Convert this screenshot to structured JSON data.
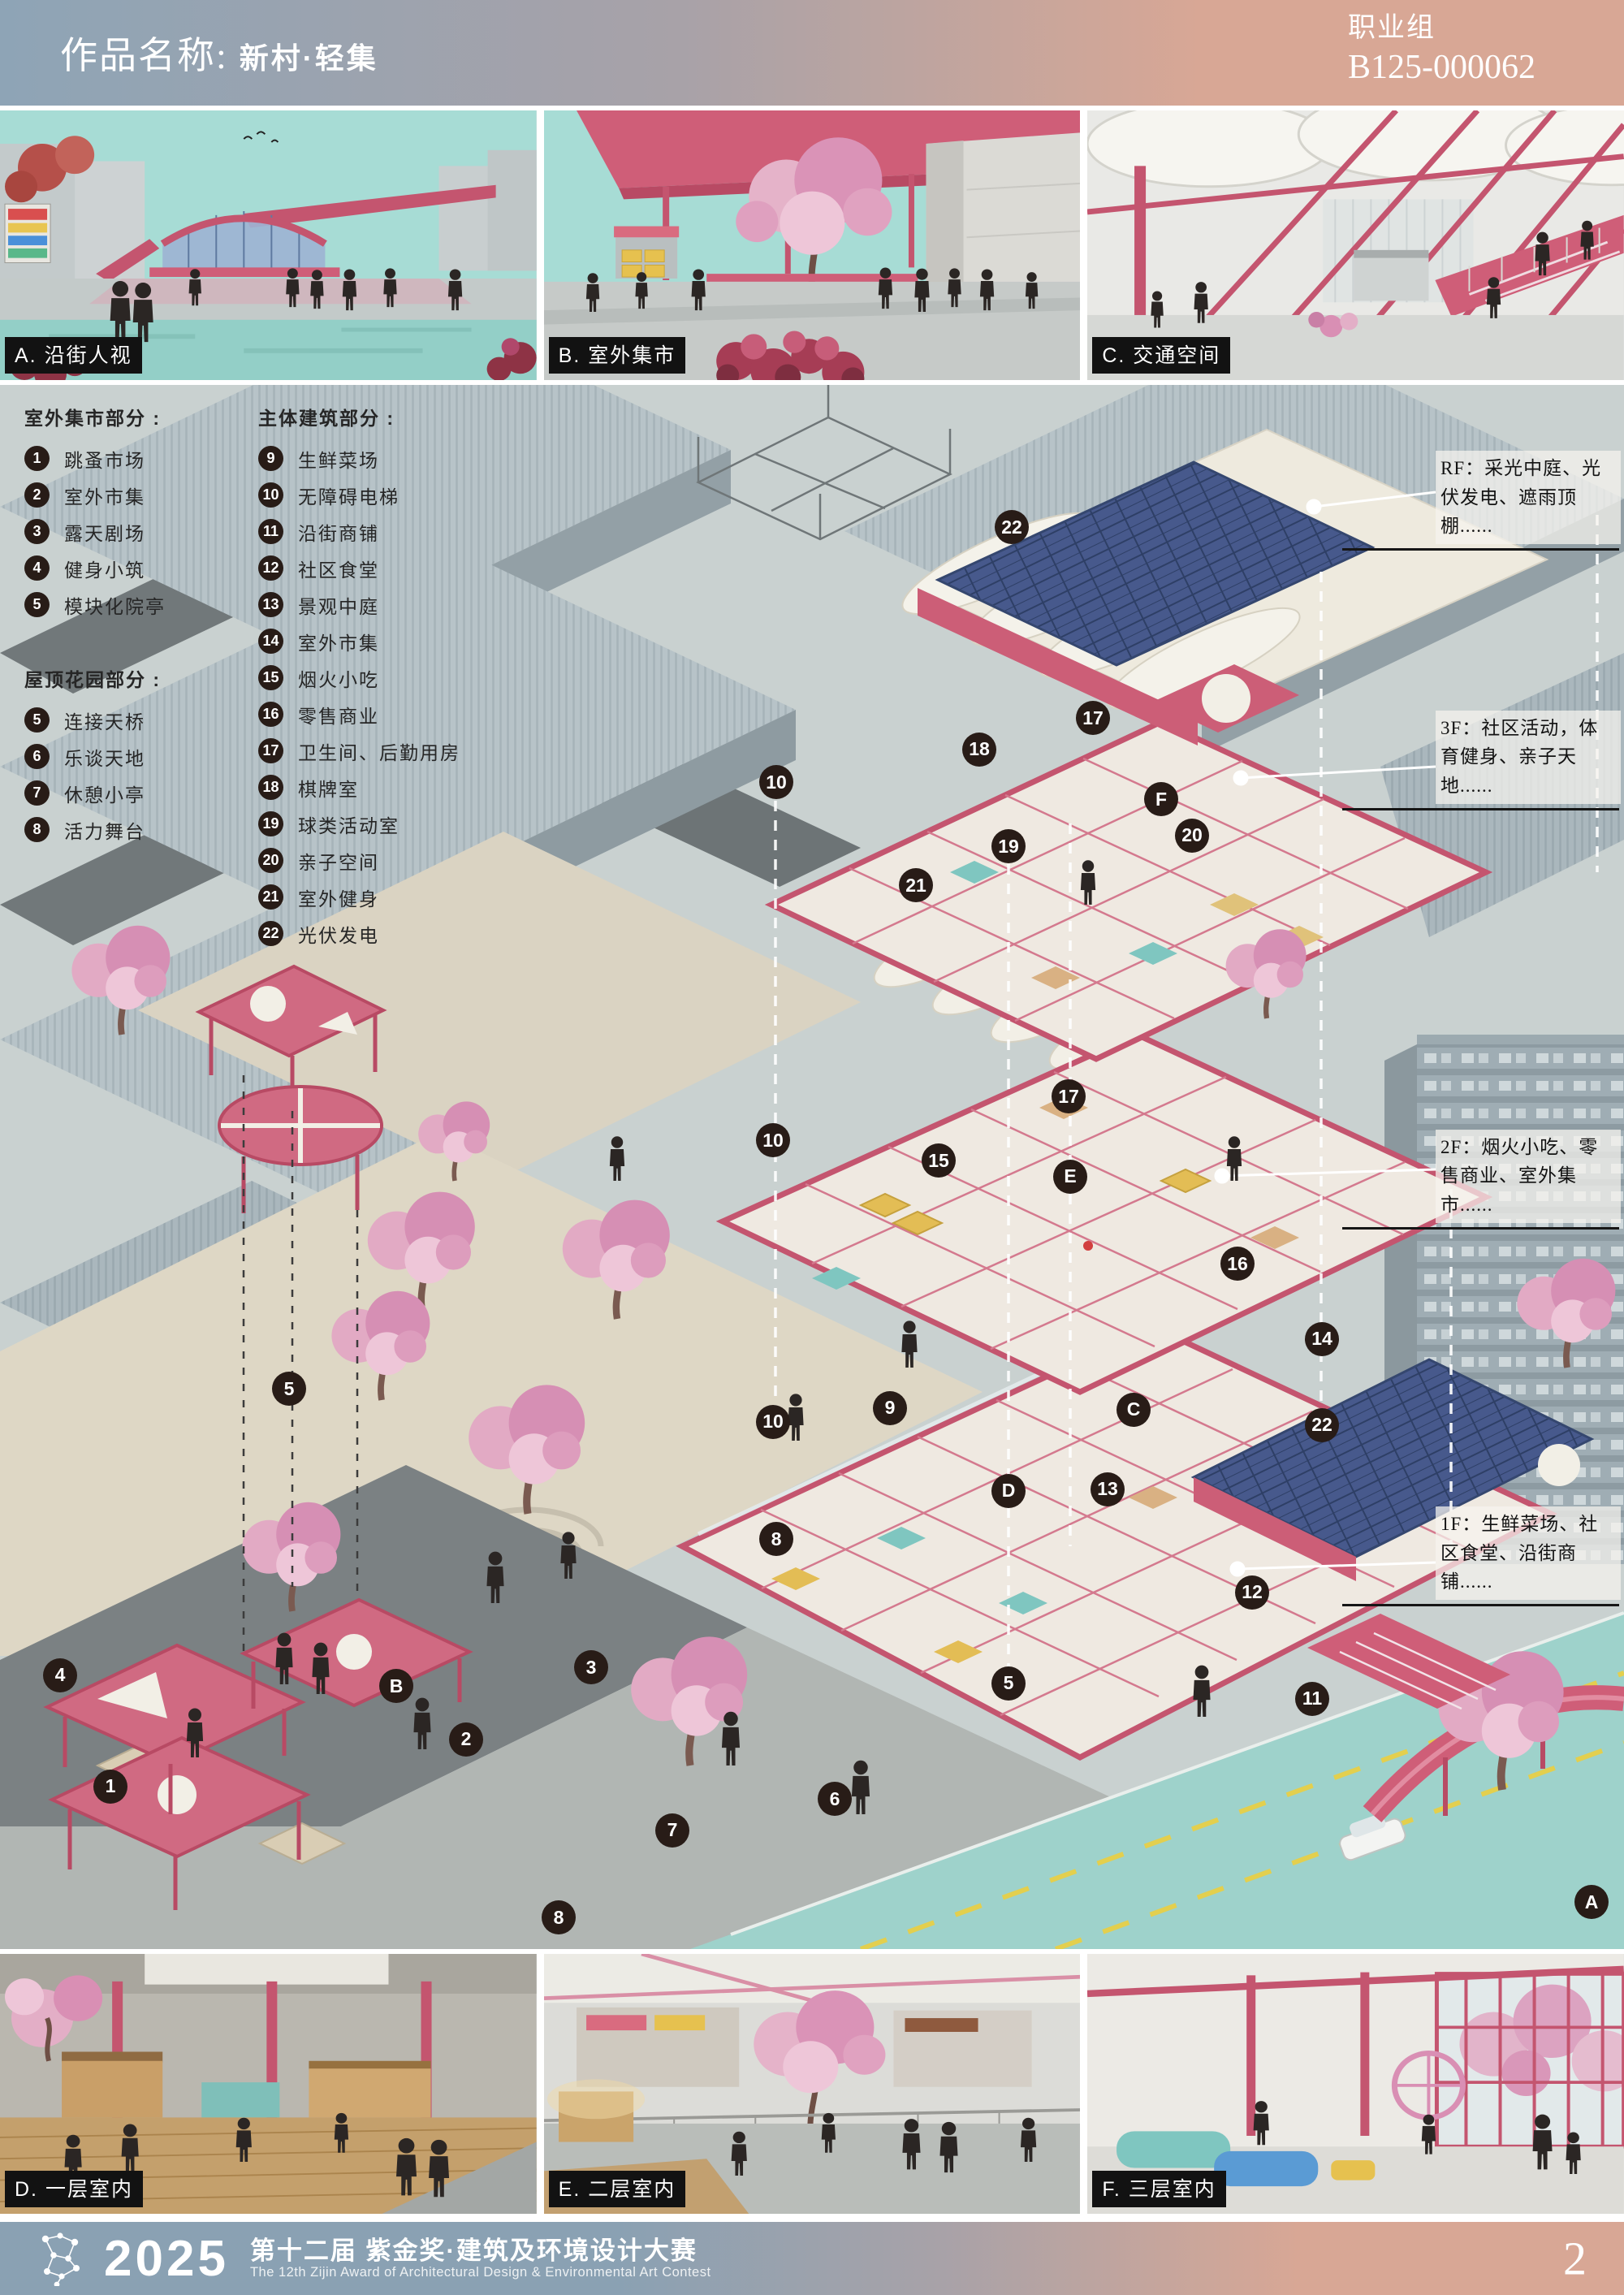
{
  "header": {
    "title_label": "作品名称:",
    "title": "新村·轻集",
    "group": "职业组",
    "entry_id": "B125-000062"
  },
  "top_photos": [
    {
      "id": "A",
      "label": "A. 沿街人视"
    },
    {
      "id": "B",
      "label": "B. 室外集市"
    },
    {
      "id": "C",
      "label": "C. 交通空间"
    }
  ],
  "bottom_photos": [
    {
      "id": "D",
      "label": "D. 一层室内"
    },
    {
      "id": "E",
      "label": "E. 二层室内"
    },
    {
      "id": "F",
      "label": "F. 三层室内"
    }
  ],
  "legend": {
    "groups": [
      {
        "title": "室外集市部分 :",
        "items": [
          {
            "num": "1",
            "label": "跳蚤市场"
          },
          {
            "num": "2",
            "label": "室外市集"
          },
          {
            "num": "3",
            "label": "露天剧场"
          },
          {
            "num": "4",
            "label": "健身小筑"
          },
          {
            "num": "5",
            "label": "模块化院亭"
          }
        ]
      },
      {
        "title": "屋顶花园部分 :",
        "items": [
          {
            "num": "5",
            "label": "连接天桥"
          },
          {
            "num": "6",
            "label": "乐谈天地"
          },
          {
            "num": "7",
            "label": "休憩小亭"
          },
          {
            "num": "8",
            "label": "活力舞台"
          }
        ]
      },
      {
        "title": "主体建筑部分 :",
        "items": [
          {
            "num": "9",
            "label": "生鲜菜场"
          },
          {
            "num": "10",
            "label": "无障碍电梯"
          },
          {
            "num": "11",
            "label": "沿街商铺"
          },
          {
            "num": "12",
            "label": "社区食堂"
          },
          {
            "num": "13",
            "label": "景观中庭"
          },
          {
            "num": "14",
            "label": "室外市集"
          },
          {
            "num": "15",
            "label": "烟火小吃"
          },
          {
            "num": "16",
            "label": "零售商业"
          },
          {
            "num": "17",
            "label": "卫生间、后勤用房"
          },
          {
            "num": "18",
            "label": "棋牌室"
          },
          {
            "num": "19",
            "label": "球类活动室"
          },
          {
            "num": "20",
            "label": "亲子空间"
          },
          {
            "num": "21",
            "label": "室外健身"
          },
          {
            "num": "22",
            "label": "光伏发电"
          }
        ]
      }
    ]
  },
  "annotations": [
    {
      "id": "RF",
      "text": "RF：采光中庭、光伏发电、遮雨顶棚......",
      "x": 88.4,
      "y": 4.2
    },
    {
      "id": "3F",
      "text": "3F：社区活动，体育健身、亲子天地......",
      "x": 88.4,
      "y": 20.8
    },
    {
      "id": "2F",
      "text": "2F：烟火小吃、零售商业、室外集市......",
      "x": 88.4,
      "y": 47.6
    },
    {
      "id": "1F",
      "text": "1F：生鲜菜场、社区食堂、沿街商铺......",
      "x": 88.4,
      "y": 71.7
    }
  ],
  "markers": [
    {
      "label": "22",
      "x": 62.3,
      "y": 9.1
    },
    {
      "label": "17",
      "x": 67.3,
      "y": 21.3
    },
    {
      "label": "18",
      "x": 60.3,
      "y": 23.3
    },
    {
      "label": "10",
      "x": 47.8,
      "y": 25.4
    },
    {
      "label": "F",
      "x": 71.5,
      "y": 26.5
    },
    {
      "label": "19",
      "x": 62.1,
      "y": 29.5
    },
    {
      "label": "20",
      "x": 73.4,
      "y": 28.8
    },
    {
      "label": "21",
      "x": 56.4,
      "y": 32.0
    },
    {
      "label": "17",
      "x": 65.8,
      "y": 45.5
    },
    {
      "label": "10",
      "x": 47.6,
      "y": 48.3
    },
    {
      "label": "15",
      "x": 57.8,
      "y": 49.6
    },
    {
      "label": "E",
      "x": 65.9,
      "y": 50.6
    },
    {
      "label": "16",
      "x": 76.2,
      "y": 56.2
    },
    {
      "label": "14",
      "x": 81.4,
      "y": 61.0
    },
    {
      "label": "5",
      "x": 17.8,
      "y": 64.2
    },
    {
      "label": "9",
      "x": 54.8,
      "y": 65.4
    },
    {
      "label": "10",
      "x": 47.6,
      "y": 66.3
    },
    {
      "label": "C",
      "x": 69.8,
      "y": 65.5
    },
    {
      "label": "22",
      "x": 81.4,
      "y": 66.5
    },
    {
      "label": "13",
      "x": 68.2,
      "y": 70.6
    },
    {
      "label": "D",
      "x": 62.1,
      "y": 70.7
    },
    {
      "label": "8",
      "x": 47.8,
      "y": 73.8
    },
    {
      "label": "12",
      "x": 77.1,
      "y": 77.2
    },
    {
      "label": "4",
      "x": 3.7,
      "y": 82.5
    },
    {
      "label": "3",
      "x": 36.4,
      "y": 82.0
    },
    {
      "label": "B",
      "x": 24.4,
      "y": 83.2
    },
    {
      "label": "5",
      "x": 62.1,
      "y": 83.0
    },
    {
      "label": "11",
      "x": 80.8,
      "y": 84.0
    },
    {
      "label": "2",
      "x": 28.7,
      "y": 86.6
    },
    {
      "label": "1",
      "x": 6.8,
      "y": 89.6
    },
    {
      "label": "6",
      "x": 51.4,
      "y": 90.4
    },
    {
      "label": "7",
      "x": 41.4,
      "y": 92.4
    },
    {
      "label": "8",
      "x": 34.4,
      "y": 98.0
    },
    {
      "label": "A",
      "x": 98.0,
      "y": 97.0
    }
  ],
  "footer": {
    "year": "2025",
    "title_cn": "第十二届 紫金奖·建筑及环境设计大赛",
    "title_en": "The 12th Zijin Award of Architectural Design & Environmental Art Contest",
    "page": "2"
  },
  "colors": {
    "grad_left": "#8ea4b6",
    "grad_right": "#d8a795",
    "marker": "#281c17",
    "accent": "#c4556f",
    "teal": "#a7dcd5",
    "solar": "#47598c",
    "label_bg": "#121212"
  }
}
